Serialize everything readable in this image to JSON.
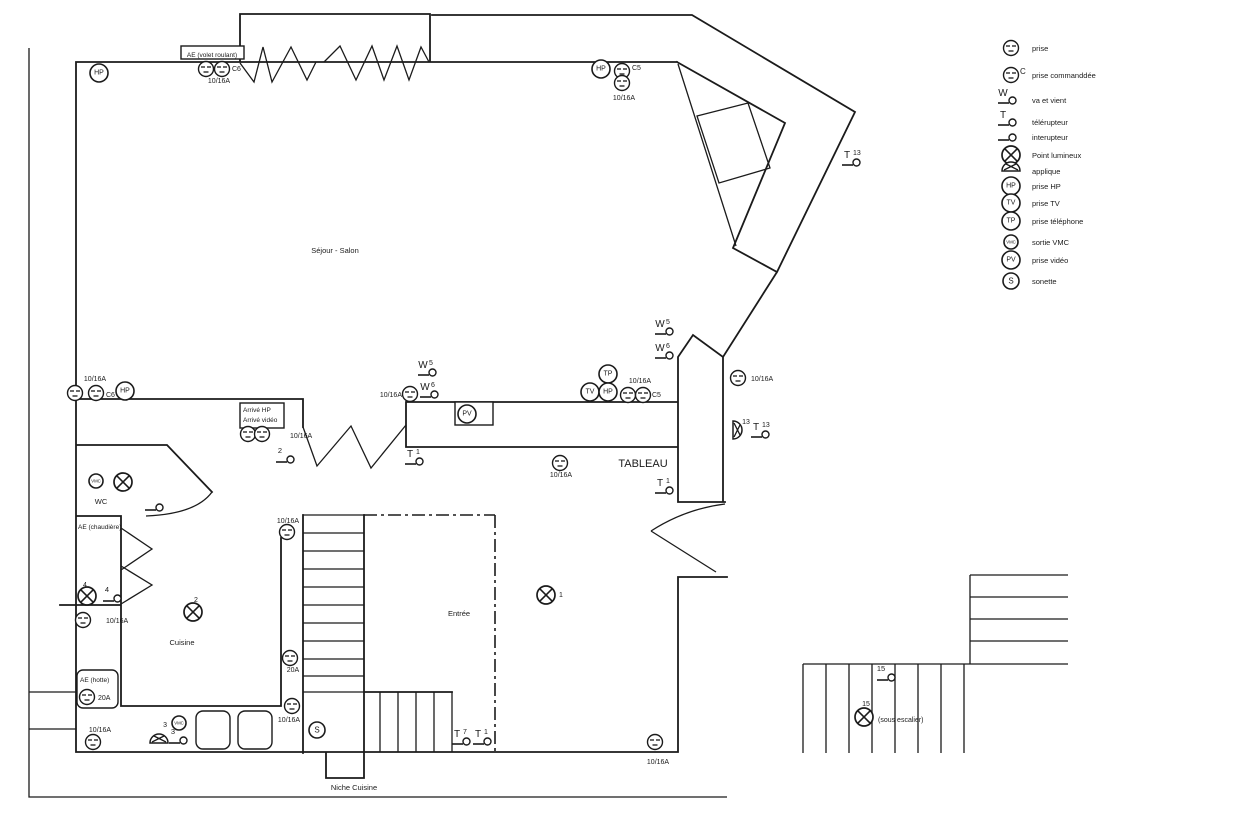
{
  "symbol_text": {
    "hp": "HP",
    "tv": "TV",
    "tp": "TP",
    "pv": "PV",
    "vmc": "VMC",
    "s": "S",
    "w": "W",
    "t": "T",
    "c": "C"
  },
  "plan": {
    "labels": [
      {
        "t": "AE (volet roulant)",
        "x": 212,
        "y": 57,
        "a": "middle",
        "s": 6.5
      },
      {
        "t": "C6",
        "x": 232,
        "y": 71,
        "a": "start",
        "s": 7
      },
      {
        "t": "10/16A",
        "x": 219,
        "y": 83,
        "a": "middle",
        "s": 7
      },
      {
        "t": "C5",
        "x": 632,
        "y": 70,
        "a": "start",
        "s": 7
      },
      {
        "t": "10/16A",
        "x": 624,
        "y": 100,
        "a": "middle",
        "s": 7
      },
      {
        "t": "Séjour - Salon",
        "x": 335,
        "y": 253,
        "a": "middle",
        "s": 7.5
      },
      {
        "t": "10/16A",
        "x": 95,
        "y": 381,
        "a": "middle",
        "s": 7
      },
      {
        "t": "C6",
        "x": 106,
        "y": 397,
        "a": "start",
        "s": 7
      },
      {
        "t": "Arrivé HP",
        "x": 243,
        "y": 412,
        "a": "start",
        "s": 6.5
      },
      {
        "t": "Arrivé vidéo",
        "x": 243,
        "y": 422,
        "a": "start",
        "s": 6.5
      },
      {
        "t": "10/16A",
        "x": 290,
        "y": 438,
        "a": "start",
        "s": 7
      },
      {
        "t": "10/16A",
        "x": 402,
        "y": 397,
        "a": "end",
        "s": 7
      },
      {
        "t": "10/16A",
        "x": 640,
        "y": 383,
        "a": "middle",
        "s": 7
      },
      {
        "t": "C5",
        "x": 652,
        "y": 397,
        "a": "start",
        "s": 7
      },
      {
        "t": "10/16A",
        "x": 751,
        "y": 381,
        "a": "start",
        "s": 7
      },
      {
        "t": "10/16A",
        "x": 561,
        "y": 477,
        "a": "middle",
        "s": 7
      },
      {
        "t": "TABLEAU",
        "x": 643,
        "y": 467,
        "a": "middle",
        "s": 11
      },
      {
        "t": "13",
        "x": 746,
        "y": 424,
        "a": "middle",
        "s": 7
      },
      {
        "t": "WC",
        "x": 101,
        "y": 504,
        "a": "middle",
        "s": 7.5
      },
      {
        "t": "AE (chaudière)",
        "x": 78,
        "y": 529,
        "a": "start",
        "s": 6.5
      },
      {
        "t": "4",
        "x": 85,
        "y": 587,
        "a": "middle",
        "s": 7
      },
      {
        "t": "2",
        "x": 196,
        "y": 602,
        "a": "middle",
        "s": 7
      },
      {
        "t": "1",
        "x": 559,
        "y": 597,
        "a": "start",
        "s": 7
      },
      {
        "t": "Cuisine",
        "x": 182,
        "y": 645,
        "a": "middle",
        "s": 7.5
      },
      {
        "t": "Entrée",
        "x": 459,
        "y": 616,
        "a": "middle",
        "s": 7.5
      },
      {
        "t": "10/16A",
        "x": 288,
        "y": 523,
        "a": "middle",
        "s": 7
      },
      {
        "t": "20A",
        "x": 293,
        "y": 672,
        "a": "middle",
        "s": 7
      },
      {
        "t": "10/16A",
        "x": 289,
        "y": 722,
        "a": "middle",
        "s": 7
      },
      {
        "t": "AE (hotte)",
        "x": 80,
        "y": 682,
        "a": "start",
        "s": 6.5
      },
      {
        "t": "20A",
        "x": 98,
        "y": 700,
        "a": "start",
        "s": 7
      },
      {
        "t": "10/16A",
        "x": 100,
        "y": 732,
        "a": "middle",
        "s": 7
      },
      {
        "t": "10/16A",
        "x": 106,
        "y": 623,
        "a": "start",
        "s": 7
      },
      {
        "t": "3",
        "x": 167,
        "y": 727,
        "a": "end",
        "s": 7
      },
      {
        "t": "Niche Cuisine",
        "x": 354,
        "y": 790,
        "a": "middle",
        "s": 7.5
      },
      {
        "t": "10/16A",
        "x": 658,
        "y": 764,
        "a": "middle",
        "s": 7
      },
      {
        "t": "15",
        "x": 866,
        "y": 706,
        "a": "middle",
        "s": 7
      },
      {
        "t": "(sous escalier)",
        "x": 878,
        "y": 722,
        "a": "start",
        "s": 7
      }
    ],
    "symbols": [
      {
        "sym": "hp",
        "x": 99,
        "y": 73
      },
      {
        "sym": "prise",
        "x": 206,
        "y": 69
      },
      {
        "sym": "prise",
        "x": 222,
        "y": 69
      },
      {
        "sym": "hp",
        "x": 601,
        "y": 69
      },
      {
        "sym": "prise",
        "x": 622,
        "y": 71
      },
      {
        "sym": "prise",
        "x": 622,
        "y": 83
      },
      {
        "sym": "sw_t",
        "x": 855,
        "y": 162,
        "sup": "13"
      },
      {
        "sym": "sw_w",
        "x": 431,
        "y": 372,
        "sup": "5"
      },
      {
        "sym": "sw_w",
        "x": 433,
        "y": 394,
        "sup": "6"
      },
      {
        "sym": "prise",
        "x": 410,
        "y": 394
      },
      {
        "sym": "pv",
        "x": 467,
        "y": 414
      },
      {
        "sym": "sw_w",
        "x": 668,
        "y": 331,
        "sup": "5"
      },
      {
        "sym": "sw_w",
        "x": 668,
        "y": 355,
        "sup": "6"
      },
      {
        "sym": "tp",
        "x": 608,
        "y": 374
      },
      {
        "sym": "tv",
        "x": 590,
        "y": 392
      },
      {
        "sym": "hp",
        "x": 608,
        "y": 392
      },
      {
        "sym": "prise",
        "x": 628,
        "y": 395
      },
      {
        "sym": "prise",
        "x": 643,
        "y": 395
      },
      {
        "sym": "prise",
        "x": 738,
        "y": 378
      },
      {
        "sym": "applique",
        "x": 733,
        "y": 430,
        "rot": 90
      },
      {
        "sym": "sw_t",
        "x": 764,
        "y": 434,
        "sup": "13"
      },
      {
        "sym": "prise",
        "x": 75,
        "y": 393
      },
      {
        "sym": "prise",
        "x": 96,
        "y": 393
      },
      {
        "sym": "hp",
        "x": 125,
        "y": 391
      },
      {
        "sym": "prise",
        "x": 248,
        "y": 434
      },
      {
        "sym": "prise",
        "x": 262,
        "y": 434
      },
      {
        "sym": "sw",
        "x": 289,
        "y": 459,
        "sup": "2"
      },
      {
        "sym": "prise",
        "x": 560,
        "y": 463
      },
      {
        "sym": "sw_t",
        "x": 418,
        "y": 461,
        "sup": "1"
      },
      {
        "sym": "sw_t",
        "x": 668,
        "y": 490,
        "sup": "1"
      },
      {
        "sym": "vmc",
        "x": 96,
        "y": 481
      },
      {
        "sym": "pl",
        "x": 123,
        "y": 482
      },
      {
        "sym": "sw",
        "x": 158,
        "y": 507
      },
      {
        "sym": "pl",
        "x": 87,
        "y": 596
      },
      {
        "sym": "sw",
        "x": 116,
        "y": 598,
        "sup": "4"
      },
      {
        "sym": "pl",
        "x": 193,
        "y": 612
      },
      {
        "sym": "prise",
        "x": 83,
        "y": 620
      },
      {
        "sym": "prise",
        "x": 87,
        "y": 697
      },
      {
        "sym": "prise",
        "x": 93,
        "y": 742
      },
      {
        "sym": "vmc",
        "x": 179,
        "y": 723
      },
      {
        "sym": "applique",
        "x": 159,
        "y": 743
      },
      {
        "sym": "sw",
        "x": 182,
        "y": 740,
        "sup": "3"
      },
      {
        "sym": "prise",
        "x": 287,
        "y": 532
      },
      {
        "sym": "prise",
        "x": 290,
        "y": 658
      },
      {
        "sym": "prise",
        "x": 292,
        "y": 706
      },
      {
        "sym": "s",
        "x": 317,
        "y": 730
      },
      {
        "sym": "pl",
        "x": 546,
        "y": 595
      },
      {
        "sym": "sw_t",
        "x": 465,
        "y": 741,
        "sup": "7"
      },
      {
        "sym": "sw_t",
        "x": 486,
        "y": 741,
        "sup": "1"
      },
      {
        "sym": "prise",
        "x": 655,
        "y": 742
      },
      {
        "sym": "sw",
        "x": 890,
        "y": 677,
        "sup": "15"
      },
      {
        "sym": "pl",
        "x": 864,
        "y": 717
      }
    ]
  },
  "legend": {
    "items": [
      {
        "sym": "prise",
        "label": "prise",
        "y": 48
      },
      {
        "sym": "prise_c",
        "label": "prise commanddée",
        "y": 75
      },
      {
        "sym": "sw_w",
        "label": "va et vient",
        "y": 100
      },
      {
        "sym": "sw_t",
        "label": "télérupteur",
        "y": 122
      },
      {
        "sym": "sw",
        "label": "interupteur",
        "y": 137
      },
      {
        "sym": "pl",
        "label": "Point lumineux",
        "y": 155
      },
      {
        "sym": "applique",
        "label": "applique",
        "y": 171
      },
      {
        "sym": "hp",
        "label": "prise HP",
        "y": 186
      },
      {
        "sym": "tv",
        "label": "prise TV",
        "y": 203
      },
      {
        "sym": "tp",
        "label": "prise téléphone",
        "y": 221
      },
      {
        "sym": "vmc",
        "label": "sortie VMC",
        "y": 242
      },
      {
        "sym": "pv",
        "label": "prise vidéo",
        "y": 260
      },
      {
        "sym": "s",
        "label": "sonette",
        "y": 281
      }
    ]
  }
}
